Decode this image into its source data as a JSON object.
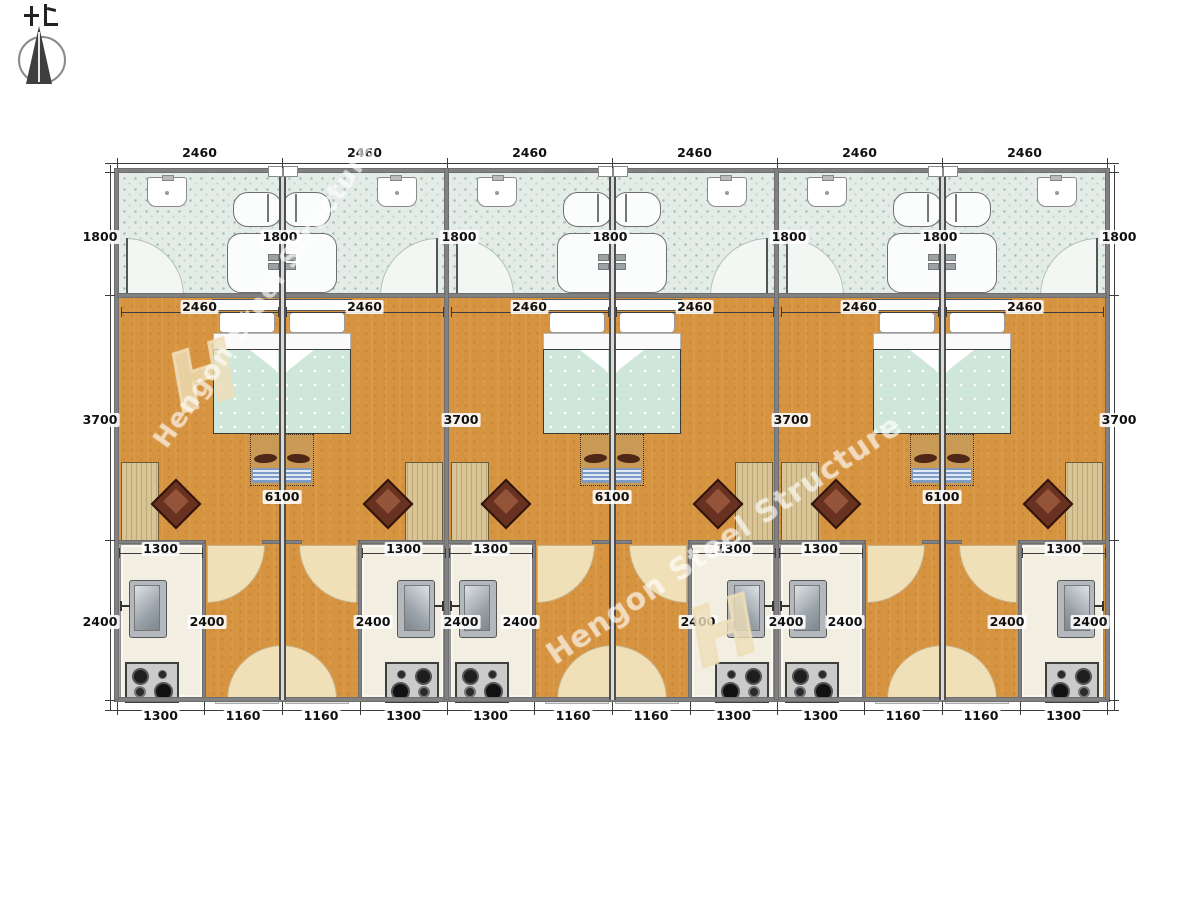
{
  "title": "container-house-floor-plan",
  "compass": {
    "label": "north-arrow",
    "character_hint": "bei (north)"
  },
  "watermark": {
    "brand": "Hengon Steel Structure",
    "logo_letter": "H"
  },
  "units": [
    {
      "id": "unit-1",
      "type": "A"
    },
    {
      "id": "unit-2",
      "type": "B"
    },
    {
      "id": "unit-3",
      "type": "A"
    },
    {
      "id": "unit-4",
      "type": "B"
    },
    {
      "id": "unit-5",
      "type": "A"
    },
    {
      "id": "unit-6",
      "type": "B"
    }
  ],
  "rooms_per_unit": [
    "bathroom",
    "bedroom",
    "kitchen",
    "entry-corridor"
  ],
  "fixtures_per_unit": [
    "wash-basin",
    "bathtub",
    "shower",
    "double-bed",
    "bench",
    "desk",
    "chair",
    "kitchen-sink",
    "stove",
    "door-swings"
  ],
  "dimensions_mm": {
    "unit_width": "2460",
    "bathroom_depth": "1800",
    "bedroom_depth": "3700",
    "kitchen_depth": "2400",
    "living_length": "6100",
    "kitchen_width": "1300",
    "corridor_width": "1160"
  },
  "dimension_labels": {
    "top": [
      "2460",
      "2460",
      "2460",
      "2460",
      "2460",
      "2460"
    ],
    "inner_width": [
      "2460",
      "2460",
      "2460",
      "2460",
      "2460",
      "2460"
    ],
    "bath_1800": [
      "1800",
      "1800",
      "1800",
      "1800",
      "1800",
      "1800",
      "1800"
    ],
    "bedroom_3700": [
      "3700",
      "3700",
      "3700",
      "3700"
    ],
    "length_6100": [
      "6100",
      "6100",
      "6100"
    ],
    "kitchen_1300": [
      "1300",
      "1300",
      "1300",
      "1300",
      "1300",
      "1300"
    ],
    "kitchen_2400": [
      "2400",
      "2400",
      "2400",
      "2400",
      "2400",
      "2400",
      "2400",
      "2400",
      "2400",
      "2400"
    ],
    "bottom": [
      "1300",
      "1160",
      "1160",
      "1300",
      "1300",
      "1160",
      "1160",
      "1300",
      "1300",
      "1160",
      "1160",
      "1300"
    ]
  },
  "colors": {
    "bathroom_tile": "#e4ece8",
    "wood_floor": "#d79440",
    "door_fan": "#efe0b8",
    "wall": "#818181",
    "duvet": "#cfe7da",
    "desk": "#d8c494",
    "chair": "#693120",
    "kitchen_counter": "#f2eee1",
    "dimension_text": "#101010"
  }
}
